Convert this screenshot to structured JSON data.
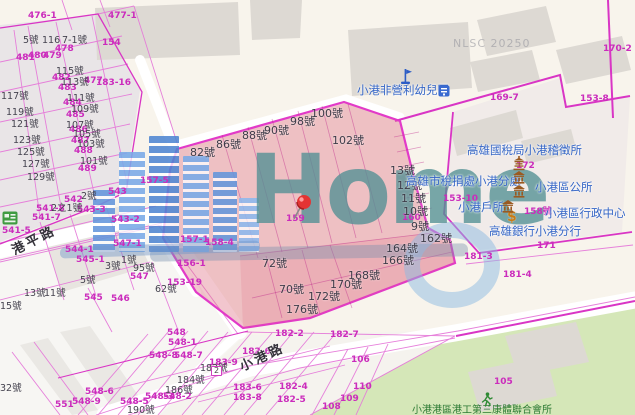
{
  "map": {
    "watermark": {
      "logo": "Home",
      "stamp": "NLSC 20250"
    },
    "roads": [
      {
        "name": "港平路"
      },
      {
        "name": "小港路"
      }
    ],
    "pois": [
      "小港非營利幼兒園",
      "高雄國稅局小港稽徵所",
      "高雄市稅捐處小港分處",
      "小港區公所",
      "小港戶所",
      "小港區行政中心",
      "高雄銀行小港分行",
      "小港港區港工第三康體聯合會所"
    ],
    "labels": [
      {
        "t": "476-1",
        "x": 28,
        "y": 12,
        "c": "m"
      },
      {
        "t": "477-1",
        "x": 108,
        "y": 12,
        "c": "m"
      },
      {
        "t": "481",
        "x": 16,
        "y": 54,
        "c": "m"
      },
      {
        "t": "480",
        "x": 28,
        "y": 52,
        "c": "m"
      },
      {
        "t": "479",
        "x": 43,
        "y": 52,
        "c": "m"
      },
      {
        "t": "478",
        "x": 55,
        "y": 45,
        "c": "m"
      },
      {
        "t": "154",
        "x": 102,
        "y": 39,
        "c": "m"
      },
      {
        "t": "482",
        "x": 52,
        "y": 74,
        "c": "m"
      },
      {
        "t": "483",
        "x": 58,
        "y": 84,
        "c": "m"
      },
      {
        "t": "477",
        "x": 84,
        "y": 77,
        "c": "m"
      },
      {
        "t": "183-16",
        "x": 96,
        "y": 79,
        "c": "m"
      },
      {
        "t": "484",
        "x": 63,
        "y": 99,
        "c": "m"
      },
      {
        "t": "485",
        "x": 66,
        "y": 111,
        "c": "m"
      },
      {
        "t": "486",
        "x": 69,
        "y": 126,
        "c": "m"
      },
      {
        "t": "487",
        "x": 71,
        "y": 137,
        "c": "m"
      },
      {
        "t": "488",
        "x": 74,
        "y": 147,
        "c": "m"
      },
      {
        "t": "489",
        "x": 78,
        "y": 165,
        "c": "m"
      },
      {
        "t": "542",
        "x": 64,
        "y": 196,
        "c": "m"
      },
      {
        "t": "543",
        "x": 108,
        "y": 188,
        "c": "m"
      },
      {
        "t": "543-3",
        "x": 77,
        "y": 206,
        "c": "m"
      },
      {
        "t": "541-8",
        "x": 36,
        "y": 205,
        "c": "m"
      },
      {
        "t": "541-7",
        "x": 32,
        "y": 214,
        "c": "m"
      },
      {
        "t": "543-2",
        "x": 111,
        "y": 216,
        "c": "m"
      },
      {
        "t": "541-5",
        "x": 2,
        "y": 227,
        "c": "m"
      },
      {
        "t": "544-1",
        "x": 65,
        "y": 246,
        "c": "m"
      },
      {
        "t": "545-1",
        "x": 76,
        "y": 256,
        "c": "m"
      },
      {
        "t": "547-1",
        "x": 113,
        "y": 240,
        "c": "m"
      },
      {
        "t": "547",
        "x": 130,
        "y": 273,
        "c": "m"
      },
      {
        "t": "545",
        "x": 84,
        "y": 294,
        "c": "m"
      },
      {
        "t": "546",
        "x": 111,
        "y": 295,
        "c": "m"
      },
      {
        "t": "157-5",
        "x": 140,
        "y": 177,
        "c": "m"
      },
      {
        "t": "157-1",
        "x": 180,
        "y": 236,
        "c": "m"
      },
      {
        "t": "158-4",
        "x": 205,
        "y": 239,
        "c": "m"
      },
      {
        "t": "156-1",
        "x": 177,
        "y": 260,
        "c": "m"
      },
      {
        "t": "153-19",
        "x": 167,
        "y": 279,
        "c": "m"
      },
      {
        "t": "159",
        "x": 286,
        "y": 215,
        "c": "m"
      },
      {
        "t": "160",
        "x": 402,
        "y": 214,
        "c": "m"
      },
      {
        "t": "153-10",
        "x": 443,
        "y": 195,
        "c": "m"
      },
      {
        "t": "169-7",
        "x": 490,
        "y": 94,
        "c": "m"
      },
      {
        "t": "153-8",
        "x": 580,
        "y": 95,
        "c": "m"
      },
      {
        "t": "170-2",
        "x": 603,
        "y": 45,
        "c": "m"
      },
      {
        "t": "172",
        "x": 516,
        "y": 162,
        "c": "m"
      },
      {
        "t": "158號",
        "x": 524,
        "y": 208,
        "c": "m"
      },
      {
        "t": "171",
        "x": 537,
        "y": 242,
        "c": "m"
      },
      {
        "t": "181-3",
        "x": 464,
        "y": 253,
        "c": "m"
      },
      {
        "t": "181-4",
        "x": 503,
        "y": 271,
        "c": "m"
      },
      {
        "t": "548",
        "x": 167,
        "y": 329,
        "c": "m"
      },
      {
        "t": "548-1",
        "x": 168,
        "y": 339,
        "c": "m"
      },
      {
        "t": "548-8",
        "x": 149,
        "y": 352,
        "c": "m"
      },
      {
        "t": "548-7",
        "x": 174,
        "y": 352,
        "c": "m"
      },
      {
        "t": "548-6",
        "x": 85,
        "y": 388,
        "c": "m"
      },
      {
        "t": "548-9",
        "x": 72,
        "y": 398,
        "c": "m"
      },
      {
        "t": "551",
        "x": 55,
        "y": 401,
        "c": "m"
      },
      {
        "t": "548-5",
        "x": 120,
        "y": 398,
        "c": "m"
      },
      {
        "t": "548-3",
        "x": 145,
        "y": 393,
        "c": "m"
      },
      {
        "t": "548-2",
        "x": 163,
        "y": 393,
        "c": "m"
      },
      {
        "t": "183-9",
        "x": 209,
        "y": 359,
        "c": "m"
      },
      {
        "t": "182-2",
        "x": 275,
        "y": 330,
        "c": "m"
      },
      {
        "t": "182-7",
        "x": 330,
        "y": 331,
        "c": "m"
      },
      {
        "t": "182-6",
        "x": 242,
        "y": 348,
        "c": "m"
      },
      {
        "t": "183-6",
        "x": 233,
        "y": 384,
        "c": "m"
      },
      {
        "t": "183-8",
        "x": 233,
        "y": 394,
        "c": "m"
      },
      {
        "t": "182-4",
        "x": 279,
        "y": 383,
        "c": "m"
      },
      {
        "t": "182-5",
        "x": 277,
        "y": 396,
        "c": "m"
      },
      {
        "t": "106",
        "x": 351,
        "y": 356,
        "c": "m"
      },
      {
        "t": "110",
        "x": 353,
        "y": 383,
        "c": "m"
      },
      {
        "t": "109",
        "x": 340,
        "y": 395,
        "c": "m"
      },
      {
        "t": "108",
        "x": 322,
        "y": 403,
        "c": "m"
      },
      {
        "t": "105",
        "x": 494,
        "y": 378,
        "c": "m"
      },
      {
        "t": "5號",
        "x": 23,
        "y": 36,
        "c": "h"
      },
      {
        "t": "116",
        "x": 42,
        "y": 36,
        "c": "h"
      },
      {
        "t": "7-1號",
        "x": 62,
        "y": 36,
        "c": "h"
      },
      {
        "t": "115號",
        "x": 56,
        "y": 67,
        "c": "h"
      },
      {
        "t": "113號",
        "x": 61,
        "y": 78,
        "c": "h"
      },
      {
        "t": "111號",
        "x": 67,
        "y": 94,
        "c": "h"
      },
      {
        "t": "109號",
        "x": 71,
        "y": 105,
        "c": "h"
      },
      {
        "t": "107號",
        "x": 66,
        "y": 121,
        "c": "h"
      },
      {
        "t": "105號",
        "x": 73,
        "y": 130,
        "c": "h"
      },
      {
        "t": "103號",
        "x": 77,
        "y": 140,
        "c": "h"
      },
      {
        "t": "101號",
        "x": 80,
        "y": 157,
        "c": "h"
      },
      {
        "t": "117號",
        "x": 1,
        "y": 92,
        "c": "h"
      },
      {
        "t": "119號",
        "x": 6,
        "y": 108,
        "c": "h"
      },
      {
        "t": "121號",
        "x": 11,
        "y": 120,
        "c": "h"
      },
      {
        "t": "123號",
        "x": 13,
        "y": 136,
        "c": "h"
      },
      {
        "t": "125號",
        "x": 17,
        "y": 148,
        "c": "h"
      },
      {
        "t": "127號",
        "x": 22,
        "y": 160,
        "c": "h"
      },
      {
        "t": "129號",
        "x": 27,
        "y": 173,
        "c": "h"
      },
      {
        "t": "2號",
        "x": 81,
        "y": 192,
        "c": "h"
      },
      {
        "t": "2之1號",
        "x": 51,
        "y": 204,
        "c": "h"
      },
      {
        "t": "1號",
        "x": 121,
        "y": 256,
        "c": "h"
      },
      {
        "t": "3號",
        "x": 105,
        "y": 262,
        "c": "h"
      },
      {
        "t": "95號",
        "x": 133,
        "y": 264,
        "c": "h"
      },
      {
        "t": "5號",
        "x": 80,
        "y": 276,
        "c": "h"
      },
      {
        "t": "13號",
        "x": 24,
        "y": 289,
        "c": "h"
      },
      {
        "t": "11號",
        "x": 44,
        "y": 289,
        "c": "h"
      },
      {
        "t": "15號",
        "x": 0,
        "y": 302,
        "c": "h"
      },
      {
        "t": "62號",
        "x": 155,
        "y": 285,
        "c": "h"
      },
      {
        "t": "32號",
        "x": 0,
        "y": 384,
        "c": "h"
      },
      {
        "t": "190號",
        "x": 127,
        "y": 406,
        "c": "h"
      },
      {
        "t": "182號",
        "x": 200,
        "y": 364,
        "c": "h"
      },
      {
        "t": "184號",
        "x": 177,
        "y": 376,
        "c": "h"
      },
      {
        "t": "186號",
        "x": 165,
        "y": 386,
        "c": "h"
      },
      {
        "t": "82號",
        "x": 190,
        "y": 147,
        "c": "p"
      },
      {
        "t": "86號",
        "x": 216,
        "y": 139,
        "c": "p"
      },
      {
        "t": "88號",
        "x": 242,
        "y": 130,
        "c": "p"
      },
      {
        "t": "90號",
        "x": 264,
        "y": 125,
        "c": "p"
      },
      {
        "t": "98號",
        "x": 290,
        "y": 116,
        "c": "p"
      },
      {
        "t": "100號",
        "x": 311,
        "y": 108,
        "c": "p"
      },
      {
        "t": "102號",
        "x": 332,
        "y": 135,
        "c": "p"
      },
      {
        "t": "13號",
        "x": 390,
        "y": 165,
        "c": "p"
      },
      {
        "t": "12號",
        "x": 397,
        "y": 180,
        "c": "p"
      },
      {
        "t": "11號",
        "x": 401,
        "y": 193,
        "c": "p"
      },
      {
        "t": "10號",
        "x": 403,
        "y": 206,
        "c": "p"
      },
      {
        "t": "9號",
        "x": 411,
        "y": 221,
        "c": "p"
      },
      {
        "t": "162號",
        "x": 420,
        "y": 233,
        "c": "p"
      },
      {
        "t": "164號",
        "x": 386,
        "y": 243,
        "c": "p"
      },
      {
        "t": "166號",
        "x": 382,
        "y": 255,
        "c": "p"
      },
      {
        "t": "168號",
        "x": 348,
        "y": 270,
        "c": "p"
      },
      {
        "t": "170號",
        "x": 330,
        "y": 279,
        "c": "p"
      },
      {
        "t": "172號",
        "x": 308,
        "y": 291,
        "c": "p"
      },
      {
        "t": "176號",
        "x": 286,
        "y": 304,
        "c": "p"
      },
      {
        "t": "72號",
        "x": 262,
        "y": 258,
        "c": "p"
      },
      {
        "t": "70號",
        "x": 279,
        "y": 284,
        "c": "p"
      },
      {
        "t": "小港非營利幼兒園",
        "x": 357,
        "y": 85,
        "c": "poi"
      },
      {
        "t": "高雄國稅局小港稽徵所",
        "x": 467,
        "y": 145,
        "c": "poi"
      },
      {
        "t": "高雄市稅捐處小港分處",
        "x": 406,
        "y": 176,
        "c": "poi"
      },
      {
        "t": "小港區公所",
        "x": 535,
        "y": 182,
        "c": "poi"
      },
      {
        "t": "小港戶所",
        "x": 458,
        "y": 202,
        "c": "poi"
      },
      {
        "t": "小港區行政中心",
        "x": 545,
        "y": 208,
        "c": "poi"
      },
      {
        "t": "高雄銀行小港分行",
        "x": 489,
        "y": 226,
        "c": "poi"
      },
      {
        "t": "港平路",
        "x": 10,
        "y": 246,
        "c": "road",
        "r": -27
      },
      {
        "t": "小港路",
        "x": 238,
        "y": 362,
        "c": "road",
        "r": -25
      },
      {
        "t": "小港港區港工第三康體聯合會所",
        "x": 412,
        "y": 406,
        "c": "g"
      },
      {
        "t": "NLSC 20250",
        "x": 453,
        "y": 38,
        "c": "wm"
      },
      {
        "t": "$",
        "x": 507,
        "y": 210,
        "c": "dollar"
      },
      {
        "t": "2",
        "x": 211,
        "y": 366,
        "c": "badge"
      }
    ],
    "icons": [
      {
        "type": "pushpin",
        "x": 290,
        "y": 193
      },
      {
        "type": "flag",
        "x": 398,
        "y": 68
      },
      {
        "type": "blue-badge",
        "x": 438,
        "y": 85
      },
      {
        "type": "pagoda",
        "x": 512,
        "y": 156
      },
      {
        "type": "gov-building",
        "x": 512,
        "y": 170
      },
      {
        "type": "gov-building",
        "x": 512,
        "y": 184
      },
      {
        "type": "gov-building",
        "x": 501,
        "y": 199
      },
      {
        "type": "runner",
        "x": 481,
        "y": 392
      },
      {
        "type": "green-badge",
        "x": 2,
        "y": 211
      }
    ],
    "colors": {
      "parcel_line": "#d935c5",
      "selection_fill": "#e8788a",
      "poi_text": "#3465c6",
      "green_area": "#d5e7b8",
      "logo_teal": "#529094"
    }
  }
}
